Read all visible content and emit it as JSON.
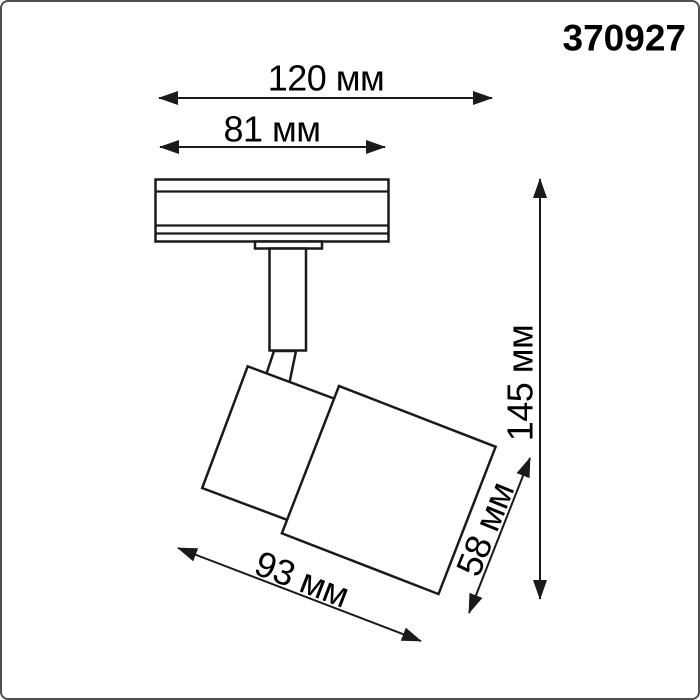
{
  "product": {
    "code": "370927"
  },
  "dimensions": {
    "track_length": "120 мм",
    "base_width": "81 мм",
    "total_height": "145 мм",
    "head_length": "93 мм",
    "head_width": "58 мм"
  },
  "colors": {
    "line": "#1a1a1a",
    "text": "#000000",
    "background": "#ffffff",
    "page_border": "#4f4f4f"
  }
}
